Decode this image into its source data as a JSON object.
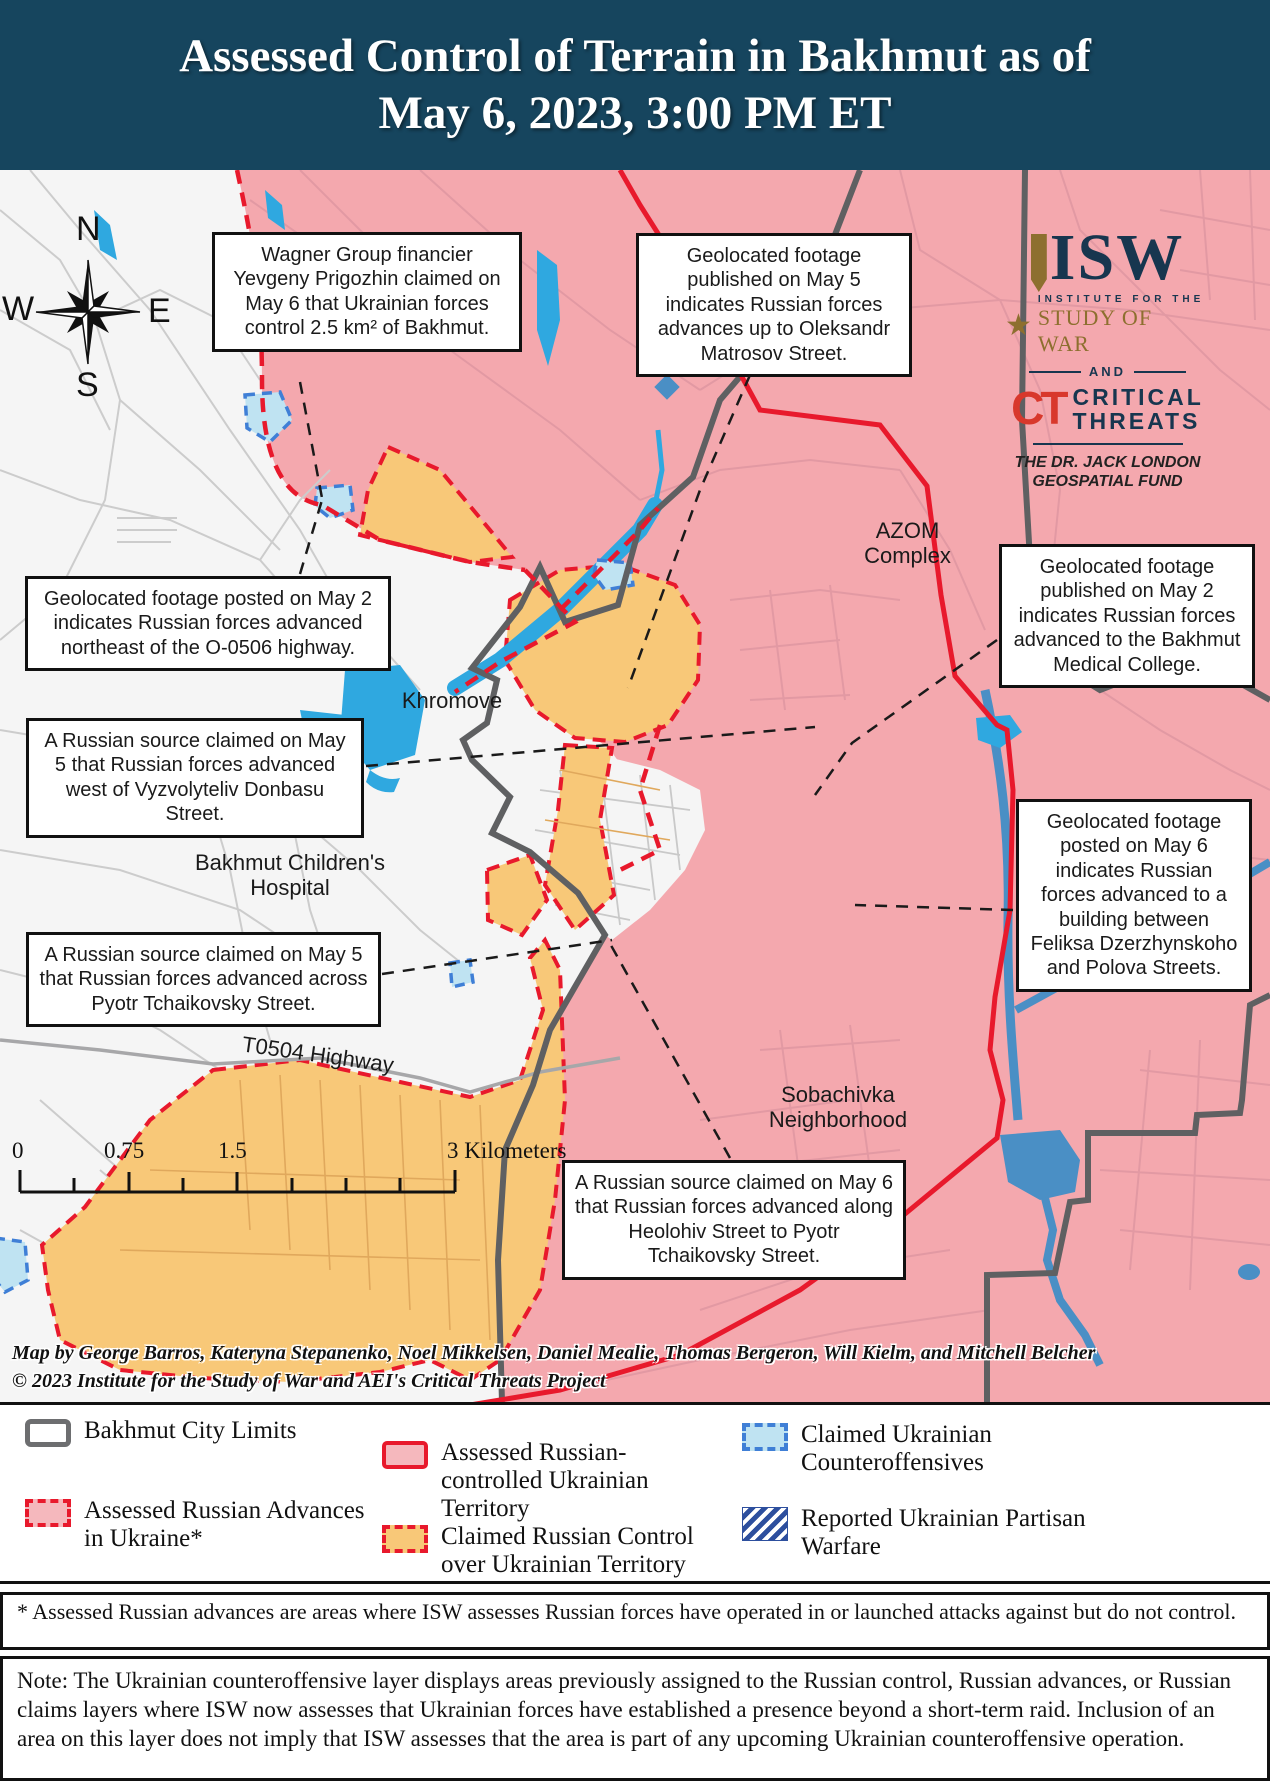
{
  "header": {
    "title_line1": "Assessed Control of Terrain in Bakhmut as of",
    "title_line2": "May 6, 2023, 3:00 PM ET"
  },
  "compass": {
    "n": "N",
    "s": "S",
    "e": "E",
    "w": "W"
  },
  "logo": {
    "isw": "ISW",
    "institute": "INSTITUTE FOR THE",
    "study": "STUDY OF WAR",
    "and": "AND",
    "ct": "CT",
    "critical": "CRITICAL",
    "threats": "THREATS",
    "fund_line1": "THE DR. JACK LONDON",
    "fund_line2": "GEOSPATIAL FUND"
  },
  "map": {
    "callouts": [
      {
        "id": "wagner",
        "text": "Wagner Group financier Yevgeny Prigozhin claimed on May 6 that Ukrainian forces control 2.5 km² of Bakhmut."
      },
      {
        "id": "matrosov",
        "text": "Geolocated footage published on May 5 indicates Russian forces advances up to Oleksandr Matrosov Street."
      },
      {
        "id": "o0506",
        "text": "Geolocated footage posted on May 2 indicates Russian forces advanced northeast of the O-0506 highway."
      },
      {
        "id": "donbasu",
        "text": "A Russian source claimed on May 5 that Russian forces advanced west of Vyzvolyteliv Donbasu Street."
      },
      {
        "id": "tchaikovsky",
        "text": "A Russian source claimed on May 5 that Russian forces advanced across Pyotr Tchaikovsky Street."
      },
      {
        "id": "college",
        "text": "Geolocated footage published on May 2 indicates Russian forces advanced to the Bakhmut Medical College."
      },
      {
        "id": "dzerzhynskoho",
        "text": "Geolocated footage posted on May 6 indicates Russian forces advanced to a building between Feliksa Dzerzhynskoho and Polova Streets."
      },
      {
        "id": "heolohiv",
        "text": "A Russian source claimed on May 6 that Russian forces advanced along Heolohiv Street to Pyotr Tchaikovsky Street."
      }
    ],
    "labels": {
      "khromove": "Khromove",
      "hospital": "Bakhmut Children's Hospital",
      "t0504": "T0504 Highway",
      "azom": "AZOM Complex",
      "sobachivka": "Sobachivka Neighborhood"
    },
    "scale": {
      "t0": "0",
      "t1": "0.75",
      "t2": "1.5",
      "t3": "3 Kilometers"
    },
    "attribution_line1": "Map by George Barros, Kateryna Stepanenko, Noel Mikkelsen, Daniel Mealie, Thomas Bergeron, Will Kielm, and Mitchell Belcher",
    "attribution_line2": "© 2023 Institute for the Study of War and AEI's Critical Threats Project"
  },
  "legend": {
    "items": [
      {
        "label": "Bakhmut City Limits"
      },
      {
        "label": "Assessed Russian Advances in Ukraine*"
      },
      {
        "label": "Assessed Russian-controlled Ukrainian Territory"
      },
      {
        "label": "Claimed Russian Control over Ukrainian Territory"
      },
      {
        "label": "Claimed Ukrainian Counteroffensives"
      },
      {
        "label": "Reported Ukrainian Partisan Warfare"
      }
    ]
  },
  "footnote": "* Assessed Russian advances are areas where ISW assesses Russian forces have operated in or launched attacks against but do not control.",
  "note": "Note: The Ukrainian counteroffensive layer displays areas previously assigned to the Russian control, Russian advances, or Russian claims layers where ISW now assesses that Ukrainian forces have established a presence beyond a short-term raid. Inclusion of an area on this layer does not imply that ISW assesses that the area is part of any upcoming Ukrainian counteroffensive operation.",
  "colors": {
    "header_navy": "#16455e",
    "russian_controlled_pink": "#f4a8ae",
    "claimed_russian_orange": "#f8c878",
    "ukrainian_white": "#f5f5f5",
    "water_blue": "#2fa8e0",
    "water_steel_blue": "#4a8fc5",
    "counteroffensive_light_blue": "#bfe3f2",
    "front_red": "#e8192c",
    "city_limits_gray": "#5f6062",
    "partisan_hatch_blue": "#2d4f9e"
  }
}
